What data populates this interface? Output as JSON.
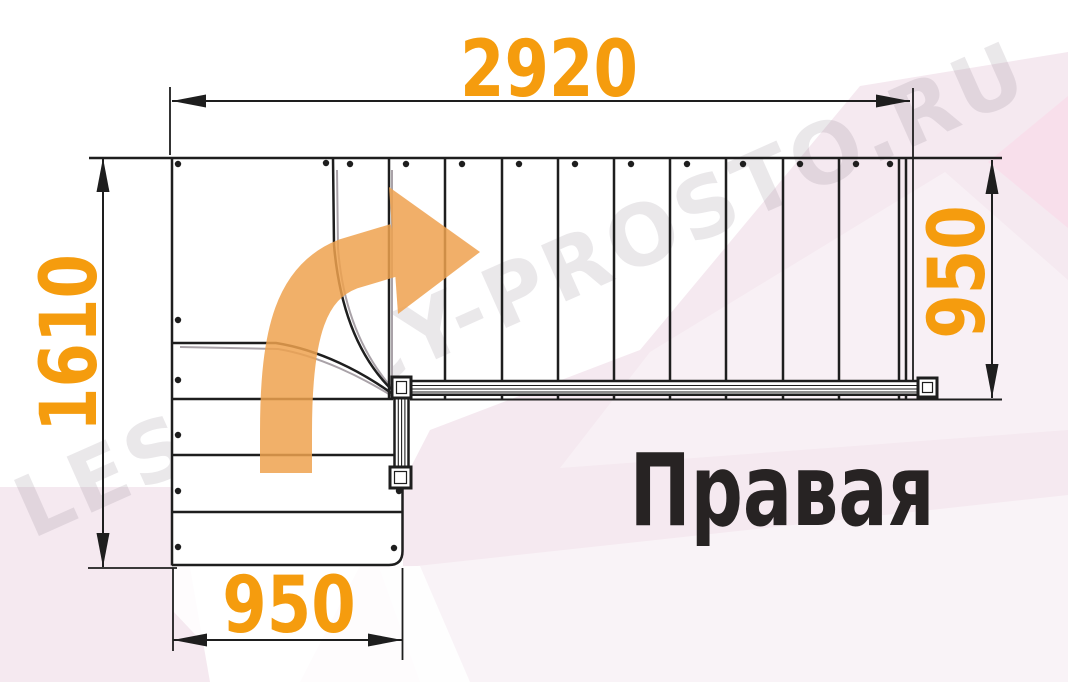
{
  "diagram": {
    "label": "Правая",
    "watermark": "LESTNICY-PROSTO.RU",
    "dimensions": {
      "top": "2920",
      "left": "1610",
      "right": "950",
      "bottom": "950"
    },
    "colors": {
      "dimension_text": "#F59C0E",
      "arrow_orange": "#EFA24F",
      "line_black": "#1e1e1e",
      "label_black": "#272323",
      "background_pink": "#f5e9f0",
      "background_pink_accent": "#f8dfeb",
      "watermark_gray": "#6E6272"
    },
    "plan": {
      "type": "staircase-floor-plan",
      "turn_direction": "right",
      "upper_flight_treads": 10,
      "winder_treads": 3,
      "lower_flight_steps": 3
    }
  }
}
